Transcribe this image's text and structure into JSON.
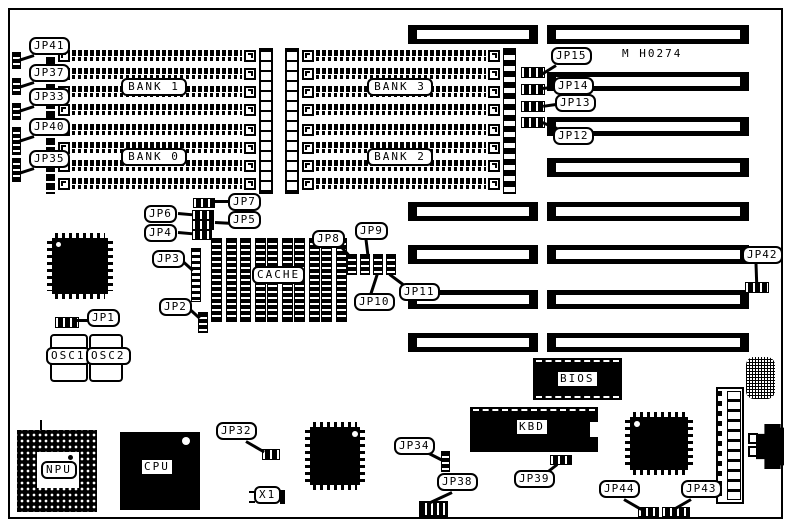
{
  "board": {
    "model_text": "M H0274"
  },
  "banks": {
    "bank0": "BANK 0",
    "bank1": "BANK 1",
    "bank2": "BANK 2",
    "bank3": "BANK 3"
  },
  "chips": {
    "cache": "CACHE",
    "osc1": "OSC1",
    "osc2": "OSC2",
    "npu": "NPU",
    "cpu": "CPU",
    "x1": "X1",
    "kbd": "KBD",
    "bios": "BIOS"
  },
  "jumpers": {
    "jp1": "JP1",
    "jp2": "JP2",
    "jp3": "JP3",
    "jp4": "JP4",
    "jp5": "JP5",
    "jp6": "JP6",
    "jp7": "JP7",
    "jp8": "JP8",
    "jp9": "JP9",
    "jp10": "JP10",
    "jp11": "JP11",
    "jp12": "JP12",
    "jp13": "JP13",
    "jp14": "JP14",
    "jp15": "JP15",
    "jp32": "JP32",
    "jp33": "JP33",
    "jp34": "JP34",
    "jp35": "JP35",
    "jp37": "JP37",
    "jp38": "JP38",
    "jp39": "JP39",
    "jp40": "JP40",
    "jp41": "JP41",
    "jp42": "JP42",
    "jp43": "JP43",
    "jp44": "JP44"
  },
  "colors": {
    "ink": "#000000",
    "paper": "#ffffff"
  }
}
